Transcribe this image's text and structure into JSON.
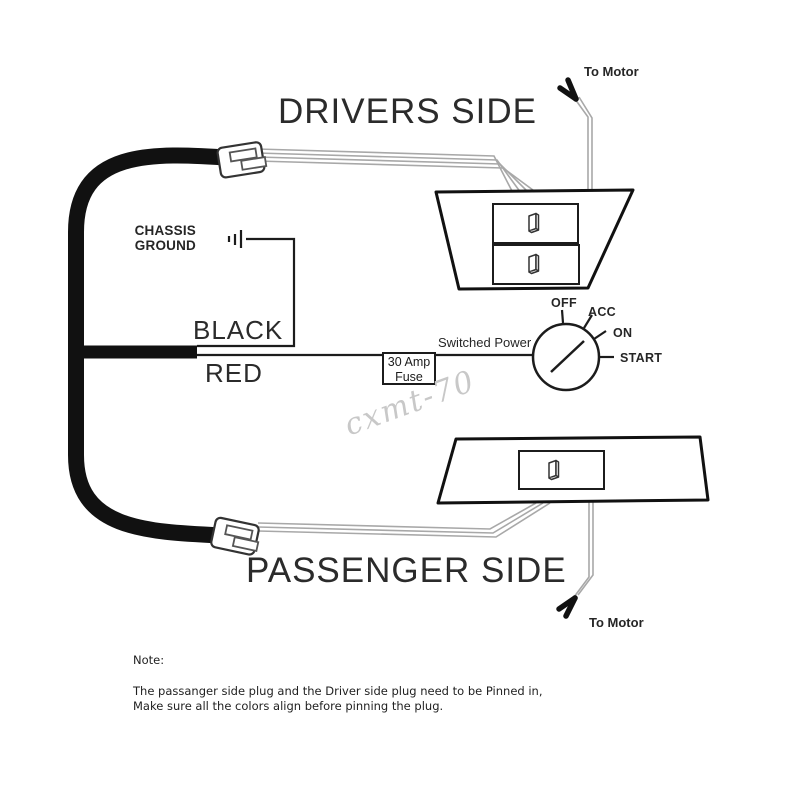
{
  "colors": {
    "line": "#1c1c1c",
    "wire": "#a8a8a8",
    "watermark": "#c8c8c8"
  },
  "diagram": {
    "drivers_side_title": "DRIVERS SIDE",
    "passenger_side_title": "PASSENGER SIDE",
    "chassis_ground_label": "CHASSIS GROUND",
    "black_wire_label": "BLACK",
    "red_wire_label": "RED",
    "fuse": {
      "line1": "30 Amp",
      "line2": "Fuse"
    },
    "switched_power_label": "Switched Power",
    "to_motor_top": "To Motor",
    "to_motor_bottom": "To Motor",
    "ignition": {
      "off": "OFF",
      "acc": "ACC",
      "on": "ON",
      "start": "START"
    }
  },
  "watermark_text": "cxmt-70",
  "note": {
    "heading": "Note:",
    "line1": "The passanger side plug and the Driver side plug need to be Pinned in,",
    "line2": "Make sure all the colors align before pinning the plug."
  }
}
